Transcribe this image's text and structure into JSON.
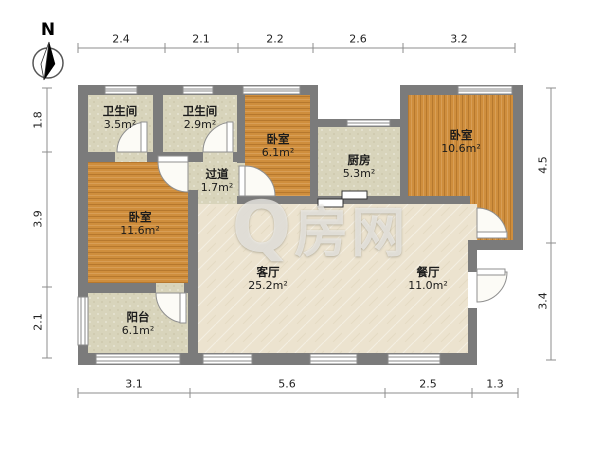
{
  "floorplan": {
    "north_label": "N",
    "watermark": {
      "q": "Q",
      "rest": "房网"
    },
    "area_unit": "m²",
    "rooms": [
      {
        "id": "bathroom-1",
        "name": "卫生间",
        "area": "3.5m²"
      },
      {
        "id": "bathroom-2",
        "name": "卫生间",
        "area": "2.9m²"
      },
      {
        "id": "bedroom-top",
        "name": "卧室",
        "area": "6.1m²"
      },
      {
        "id": "kitchen",
        "name": "厨房",
        "area": "5.3m²"
      },
      {
        "id": "bedroom-right",
        "name": "卧室",
        "area": "10.6m²"
      },
      {
        "id": "hallway",
        "name": "过道",
        "area": "1.7m²"
      },
      {
        "id": "bedroom-left",
        "name": "卧室",
        "area": "11.6m²"
      },
      {
        "id": "living-room",
        "name": "客厅",
        "area": "25.2m²"
      },
      {
        "id": "dining-room",
        "name": "餐厅",
        "area": "11.0m²"
      },
      {
        "id": "balcony",
        "name": "阳台",
        "area": "6.1m²"
      }
    ],
    "dimensions": {
      "top": [
        "2.4",
        "2.1",
        "2.2",
        "2.6",
        "3.2"
      ],
      "left": [
        "1.8",
        "3.9",
        "2.1"
      ],
      "right": [
        "4.5",
        "3.4"
      ],
      "bottom": [
        "3.1",
        "5.6",
        "2.5",
        "1.3"
      ]
    },
    "colors": {
      "wall": "#7b7b7b",
      "wood_floor": "#cf8e3d",
      "tile_floor": "#d8d4bb",
      "main_floor": "#ece3cf"
    }
  }
}
